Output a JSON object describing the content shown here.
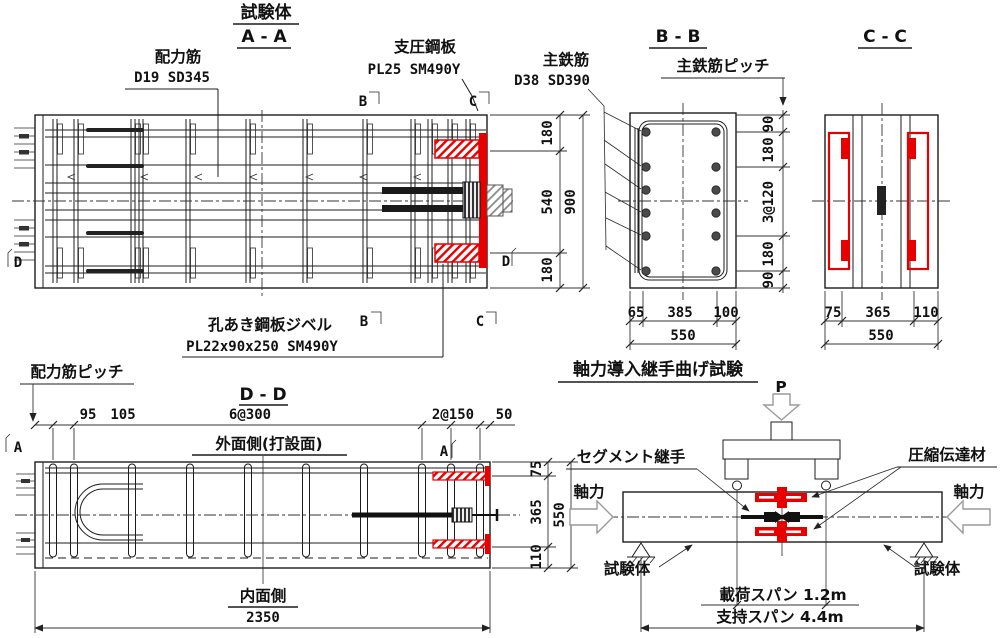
{
  "titles": {
    "specimen_header": "試験体",
    "section_aa": "A - A",
    "section_bb": "B - B",
    "section_cc": "C - C",
    "section_dd": "D - D",
    "bending_test": "軸力導入継手曲げ試験"
  },
  "labels": {
    "distribution_bar": "配力筋",
    "distribution_bar_spec": "D19 SD345",
    "bearing_plate": "支圧鋼板",
    "bearing_plate_spec": "PL25 SM490Y",
    "main_bar": "主鉄筋",
    "main_bar_spec": "D38 SD390",
    "main_bar_pitch": "主鉄筋ピッチ",
    "perforated_plate_dowel": "孔あき鋼板ジベル",
    "perforated_plate_dowel_spec": "PL22x90x250 SM490Y",
    "distribution_bar_pitch": "配力筋ピッチ",
    "outer_face": "外面側(打設面)",
    "inner_face": "内面側",
    "load_p": "P",
    "segment_joint": "セグメント継手",
    "compression_transfer": "圧縮伝達材",
    "axial_force": "軸力",
    "specimen": "試験体",
    "loading_span": "載荷スパン 1.2m",
    "support_span": "支持スパン 4.4m"
  },
  "markers": {
    "a": "A",
    "b": "B",
    "c": "C",
    "d": "D"
  },
  "dims": {
    "aa_right": [
      "180",
      "540",
      "180"
    ],
    "aa_total": "900",
    "bb_right": [
      "90",
      "180",
      "3@120",
      "180",
      "90"
    ],
    "bb_bottom": [
      "65",
      "385",
      "100"
    ],
    "bb_width": "550",
    "cc_bottom": [
      "75",
      "365",
      "110"
    ],
    "cc_width": "550",
    "dd_top": [
      "95",
      "105",
      "6@300",
      "2@150",
      "50"
    ],
    "dd_right": [
      "75",
      "365",
      "110"
    ],
    "dd_height": "550",
    "dd_length": "2350"
  },
  "colors": {
    "line": "#1c1c1c",
    "red": "#e60000",
    "arrow_gray": "#9a9a9a"
  }
}
